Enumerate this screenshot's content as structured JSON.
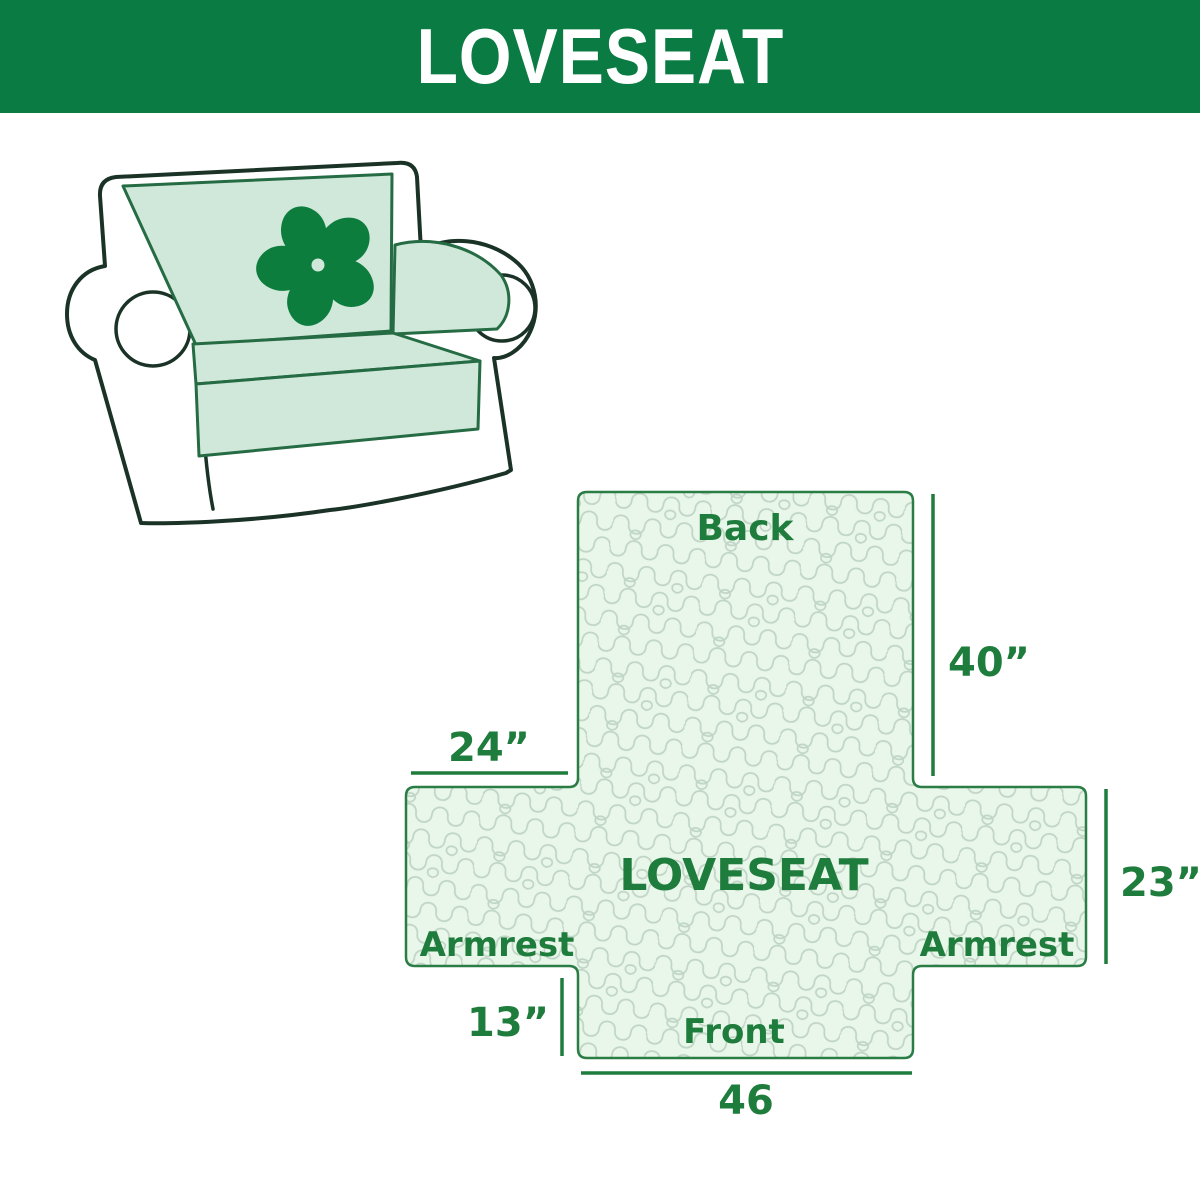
{
  "header": {
    "title": "LOVESEAT",
    "bg_color": "#0a7b42",
    "text_color": "#ffffff"
  },
  "illustration": {
    "description": "loveseat sofa line drawing with mint slipcover on back, seat and right armrest",
    "logo_icon": "pinwheel-flower-icon",
    "cover_color": "#cfe8da",
    "outline_color": "#1b3326",
    "logo_color": "#0d7d3e"
  },
  "diagram": {
    "center_label": "LOVESEAT",
    "back_label": "Back",
    "front_label": "Front",
    "armrest_left_label": "Armrest",
    "armrest_right_label": "Armrest",
    "dim_back_height": "40”",
    "dim_armrest_width": "24”",
    "dim_armrest_height": "23”",
    "dim_front_drop": "13”",
    "dim_front_width": "46",
    "fill_color": "#e9f6ea",
    "pattern_color": "#bfd5c5",
    "border_color": "#2a7d45",
    "text_color": "#1e7c3c"
  }
}
